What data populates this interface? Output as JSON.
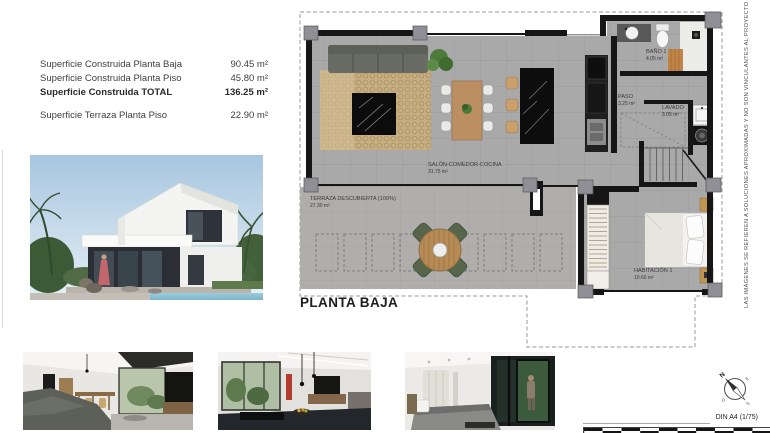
{
  "surface_table": {
    "rows": [
      {
        "label": "Superficie Construida Planta Baja",
        "value": "90.45 m²"
      },
      {
        "label": "Superficie Construida Planta Piso",
        "value": "45.80 m²"
      },
      {
        "label": "Superficie Construida TOTAL",
        "value": "136.25 m²"
      },
      {
        "label": "Superficie Terraza Planta Piso",
        "value": "22.90 m²"
      }
    ]
  },
  "plan": {
    "title": "PLANTA BAJA",
    "rooms": [
      {
        "name": "SALÓN-COMEDOR-COCINA",
        "area": "31.75 m²"
      },
      {
        "name": "TERRAZA DESCUBIERTA (100%)",
        "area": "27.30 m²"
      },
      {
        "name": "BAÑO 1",
        "area": "4.05 m²"
      },
      {
        "name": "PASO",
        "area": "3.25 m²"
      },
      {
        "name": "LAVADO",
        "area": "3.05 m²"
      },
      {
        "name": "HABITACIÓN 1",
        "area": "10.60 m²"
      }
    ]
  },
  "sidebar": {
    "disclaimer": "LAS IMÁGENES SE REFIEREN A SOLUCIONES APROXIMADAS Y NO SON VINCULANTES AL PROYECTO FINAL",
    "sheet_label": "DIN A4 (1/75)",
    "compass": {
      "n": "N",
      "e": "E",
      "s": "S",
      "o": "O"
    }
  },
  "colors": {
    "floor": "#a9a9a9",
    "terrace_floor": "#b0aeac",
    "wall": "#161616",
    "mullion": "#8f8f95",
    "wood": "#bb8f62",
    "sky": "#aac9e2",
    "pool": "#8fc3d8"
  }
}
